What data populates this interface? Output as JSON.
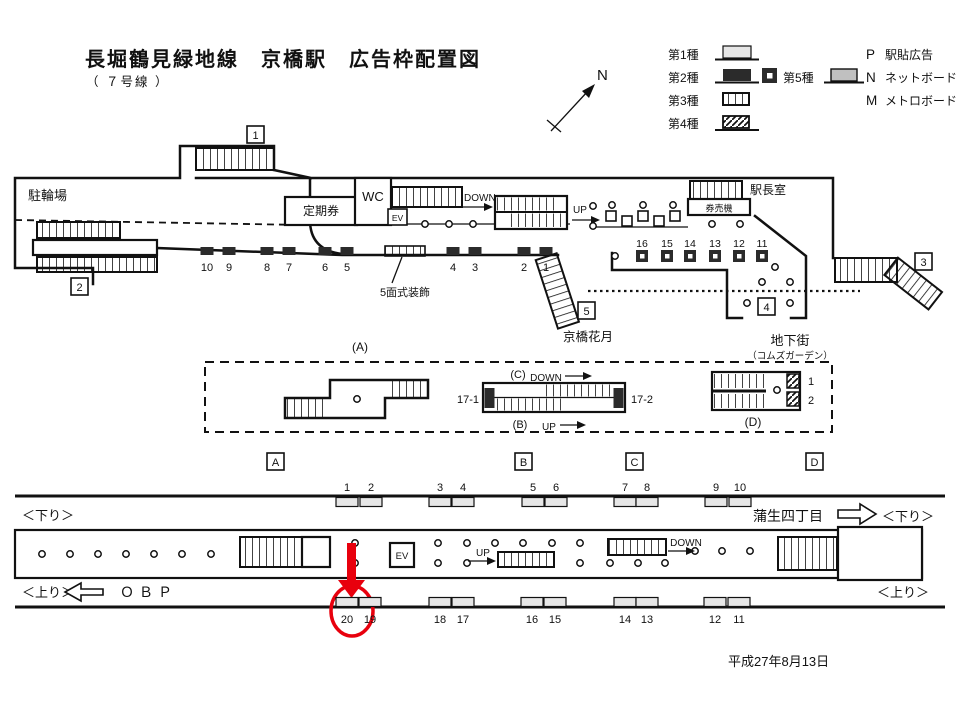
{
  "header": {
    "title": "長堀鶴見緑地線　京橋駅　広告枠配置図",
    "subtitle": "（ ７号線 ）"
  },
  "compass": {
    "label": "N"
  },
  "legend": {
    "type1": "第1種",
    "type2": "第2種",
    "type3": "第3種",
    "type4": "第4種",
    "type5": "第5種",
    "p_key": "P",
    "p_label": "駅貼広告",
    "n_key": "N",
    "n_label": "ネットボード",
    "m_key": "M",
    "m_label": "メトロボード"
  },
  "concourse": {
    "bicycle_parking": "駐輪場",
    "commuter_pass": "定期券",
    "wc": "WC",
    "ev": "EV",
    "ticket_machines": "券売機",
    "station_master": "駅長室",
    "down": "DOWN",
    "up": "UP",
    "deco_label": "5面式装飾",
    "kagetsu": "京橋花月",
    "underground_mall": "地下街",
    "comms_garden": "（コムズガーデン）",
    "exit1": "1",
    "exit2": "2",
    "exit3": "3",
    "exit4": "4",
    "exit5": "5",
    "type2_ads": [
      "10",
      "9",
      "8",
      "7",
      "6",
      "5",
      "4",
      "3",
      "2",
      "1"
    ],
    "type5_ads": [
      "16",
      "15",
      "14",
      "13",
      "12",
      "11"
    ]
  },
  "mezzanine": {
    "label_a": "(A)",
    "label_b": "(B)",
    "label_c": "(C)",
    "label_d": "(D)",
    "down": "DOWN",
    "up": "UP",
    "esc_left": "17-1",
    "esc_right": "17-2",
    "d_ad1": "1",
    "d_ad2": "2"
  },
  "stair_markers": [
    "A",
    "B",
    "C",
    "D"
  ],
  "platform": {
    "down_left": "＜下り＞",
    "down_right": "＜下り＞",
    "up_left": "＜上り＞",
    "up_right": "＜上り＞",
    "obp": "ＯＢＰ",
    "gamo": "蒲生四丁目",
    "ev": "EV",
    "up": "UP",
    "down": "DOWN",
    "top_ads": [
      "1",
      "2",
      "3",
      "4",
      "5",
      "6",
      "7",
      "8",
      "9",
      "10"
    ],
    "bottom_ads": [
      "20",
      "19",
      "18",
      "17",
      "16",
      "15",
      "14",
      "13",
      "12",
      "11"
    ]
  },
  "date": "平成27年8月13日",
  "colors": {
    "accent_red": "#e8000d",
    "ad_dark": "#2b2b2b",
    "ad_light": "#e6e6e6",
    "net_gray": "#c0c0c0",
    "line": "#111111"
  }
}
